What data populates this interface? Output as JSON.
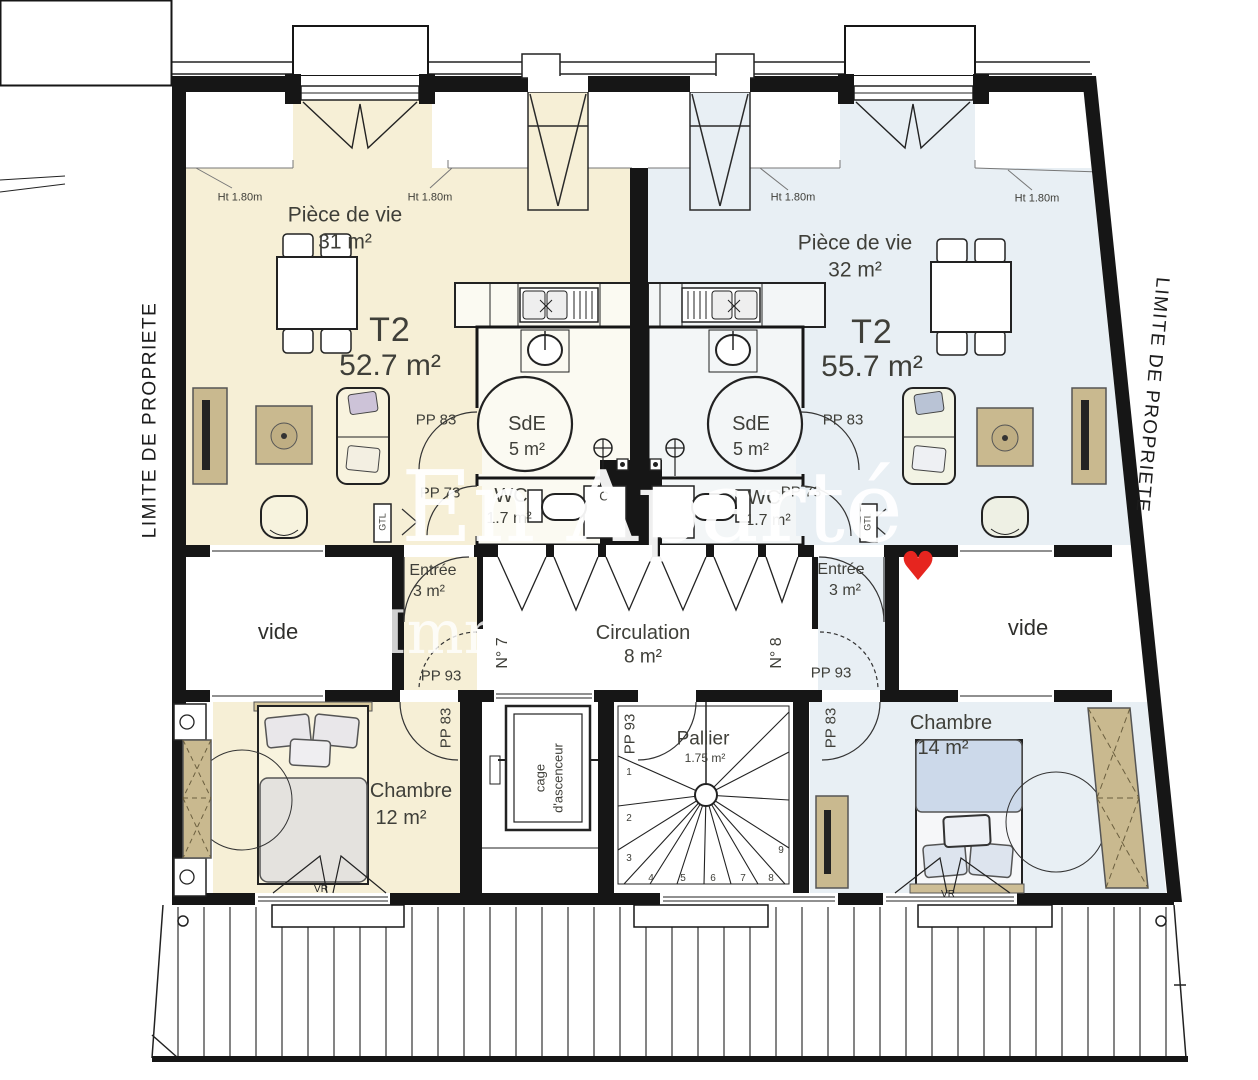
{
  "colors": {
    "left": "#f6efd6",
    "right": "#e8eff4",
    "wood": "#c9b98f",
    "heart": "#e6251f",
    "wall": "#161616",
    "watermark": "#ffffff"
  },
  "watermark": {
    "line1": "En Aparté",
    "line2": "Immobilier",
    "heart": "♥"
  },
  "site": {
    "limite": "LIMITE DE PROPRIETE"
  },
  "left": {
    "unit": "N° 7",
    "type": "T2",
    "area": "52.7 m²",
    "living": "Pièce de vie",
    "living_area": "31 m²",
    "sde": "SdE",
    "sde_area": "5 m²",
    "wc": "WC",
    "wc_area": "1.7 m²",
    "entree": "Entrée",
    "entree_area": "3 m²",
    "chambre": "Chambre",
    "chambre_area": "12 m²",
    "ht": "Ht 1.80m",
    "door_sde": "PP 83",
    "door_wc": "PP 73",
    "door_entree": "PP 93",
    "door_chambre": "PP 83",
    "gtl": "GTL",
    "vr": "VR",
    "vide": "vide",
    "cupboard": "C"
  },
  "right": {
    "unit": "N° 8",
    "type": "T2",
    "area": "55.7 m²",
    "living": "Pièce de vie",
    "living_area": "32 m²",
    "sde": "SdE",
    "sde_area": "5 m²",
    "wc": "WC",
    "wc_area": "1.7 m²",
    "entree": "Entrée",
    "entree_area": "3 m²",
    "chambre": "Chambre",
    "chambre_area": "14 m²",
    "ht": "Ht 1.80m",
    "door_sde": "PP 83",
    "door_wc": "PP 73",
    "door_entree": "PP 93",
    "door_chambre": "PP 83",
    "gtl": "GTL",
    "vr": "VR",
    "vide": "vide"
  },
  "common": {
    "circulation": "Circulation",
    "circulation_area": "8 m²",
    "pallier": "Pallier",
    "pallier_area": "1.75 m²",
    "door_pallier": "PP 93",
    "elevator_line1": "cage",
    "elevator_line2": "d'ascenceur",
    "steps": [
      "1",
      "2",
      "3",
      "4",
      "5",
      "6",
      "7",
      "8",
      "9"
    ]
  }
}
